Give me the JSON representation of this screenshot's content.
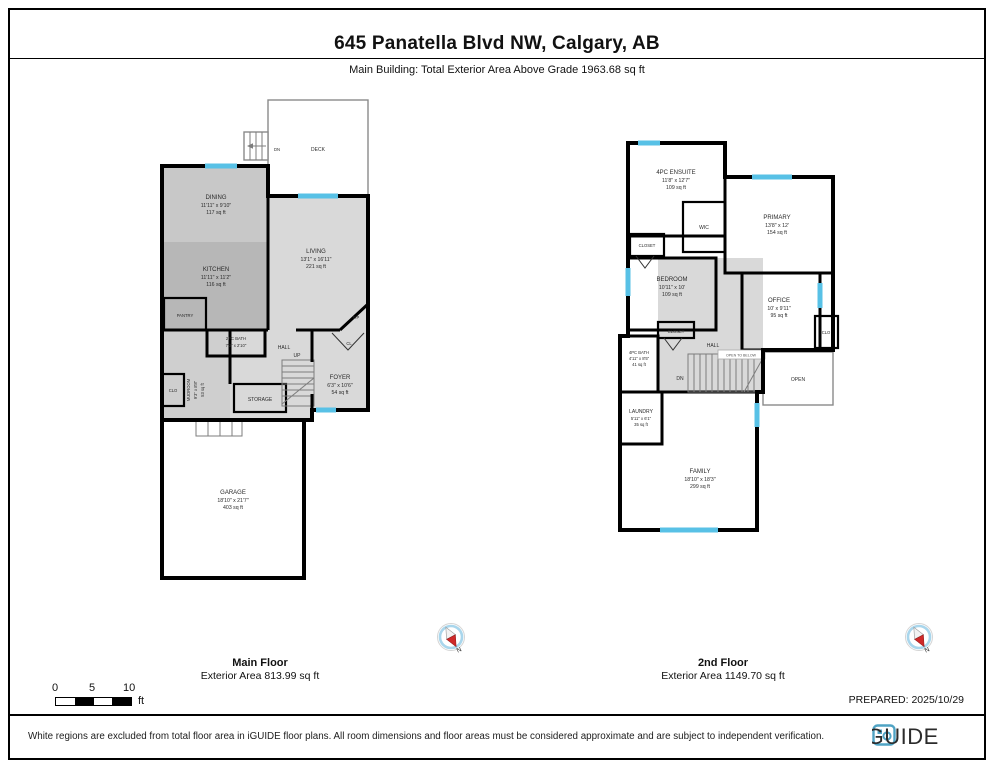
{
  "header": {
    "title": "645 Panatella Blvd NW, Calgary, AB",
    "subtitle": "Main Building: Total Exterior Area Above Grade 1963.68 sq ft"
  },
  "mf": {
    "title": "Main Floor",
    "area": "Exterior Area 813.99 sq ft",
    "deck": "DECK",
    "dn": "DN",
    "up": "UP",
    "hall": "HALL",
    "pantry": "PANTRY",
    "cl": "CL",
    "fp": "F/P",
    "clo": "CLO",
    "storage": "STORAGE",
    "dining": {
      "n": "DINING",
      "d": "11'11\" x 9'10\"",
      "a": "117 sq ft"
    },
    "kitchen": {
      "n": "KITCHEN",
      "d": "11'11\" x 11'2\"",
      "a": "116 sq ft"
    },
    "living": {
      "n": "LIVING",
      "d": "13'1\" x 16'11\"",
      "a": "221 sq ft"
    },
    "bath": {
      "n": "2PC BATH",
      "d": "7'3\" x 2'10\""
    },
    "mudroom": {
      "n": "MUDROOM",
      "d": "9'3\" x 8'8\"",
      "a": "53 sq ft"
    },
    "foyer": {
      "n": "FOYER",
      "d": "6'3\" x 10'6\"",
      "a": "54 sq ft"
    },
    "garage": {
      "n": "GARAGE",
      "d": "18'10\" x 21'7\"",
      "a": "403 sq ft"
    }
  },
  "sf": {
    "title": "2nd Floor",
    "area": "Exterior Area 1149.70 sq ft",
    "wic": "WIC",
    "closet_top": "CLOSET",
    "closet_mid": "CLOSET",
    "clo": "CLO",
    "hall": "HALL",
    "open": "OPEN",
    "otb": "OPEN TO BELOW",
    "dn": "DN",
    "ensuite": {
      "n": "4PC ENSUITE",
      "d": "11'8\" x 12'7\"",
      "a": "109 sq ft"
    },
    "primary": {
      "n": "PRIMARY",
      "d": "13'8\" x 12'",
      "a": "154 sq ft"
    },
    "bedroom": {
      "n": "BEDROOM",
      "d": "10'11\" x 10'",
      "a": "109 sq ft"
    },
    "office": {
      "n": "OFFICE",
      "d": "10' x 9'11\"",
      "a": "95 sq ft"
    },
    "bath": {
      "n": "4PC BATH",
      "d": "4'11\" x 8'5\"",
      "a": "41 sq ft"
    },
    "laundry": {
      "n": "LAUNDRY",
      "d": "5'11\" x 6'1\"",
      "a": "35 sq ft"
    },
    "family": {
      "n": "FAMILY",
      "d": "18'10\" x 18'3\"",
      "a": "299 sq ft"
    }
  },
  "compass": {
    "n": "N"
  },
  "scale": {
    "t0": "0",
    "t5": "5",
    "t10": "10",
    "unit": "ft"
  },
  "footer": {
    "prepared": "PREPARED: 2025/10/29",
    "disclaimer": "White regions are excluded from total floor area in iGUIDE floor plans. All room dimensions and floor areas must be considered approximate and are subject to independent verification.",
    "logo": "iGUIDE"
  },
  "colors": {
    "window": "#58c1e6",
    "wall": "#000000",
    "brand": "#4fa3c4"
  }
}
